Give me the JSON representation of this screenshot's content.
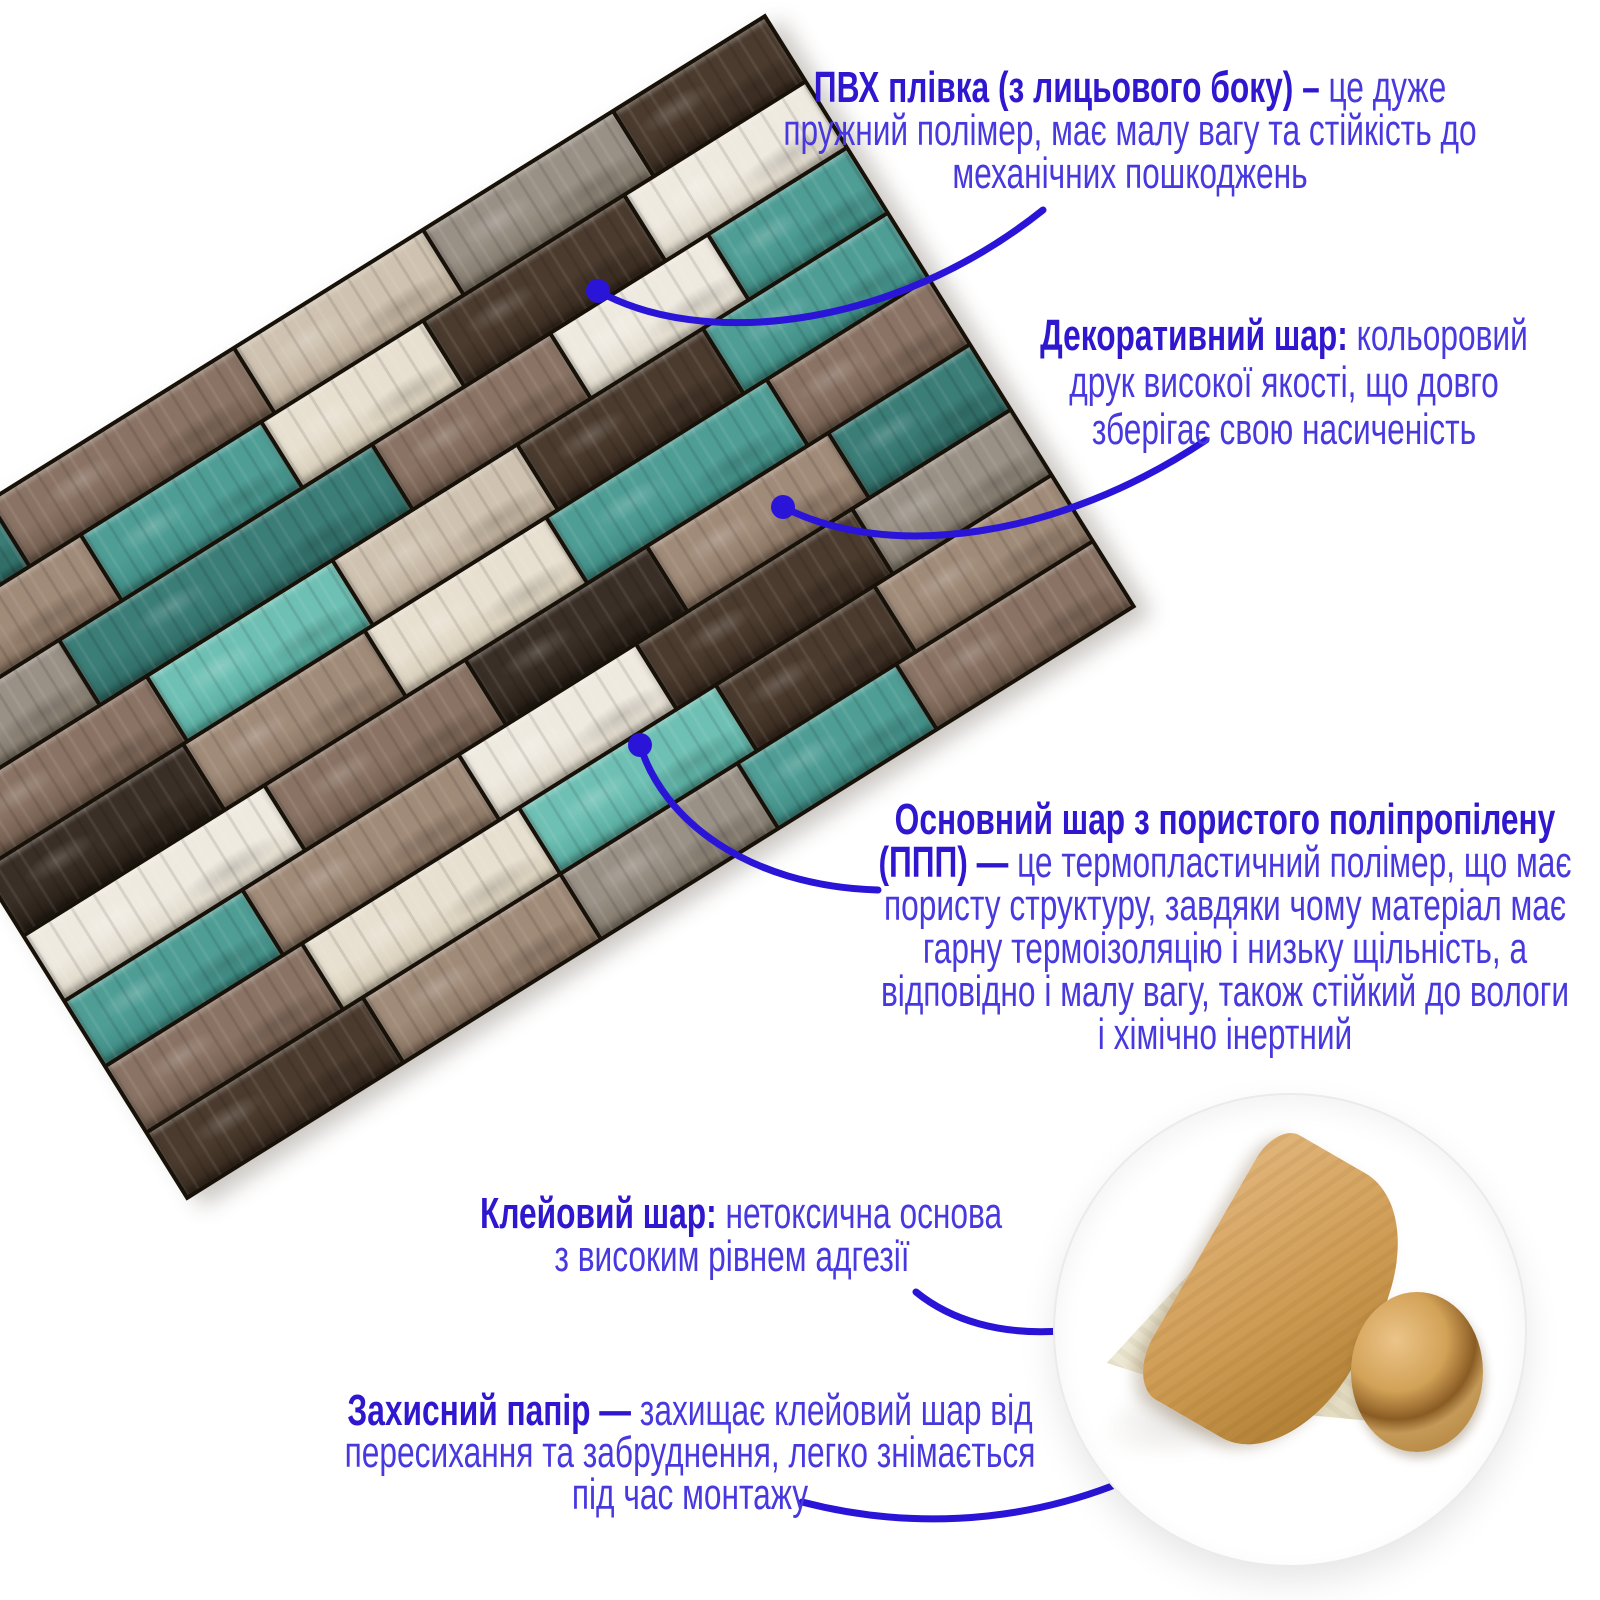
{
  "colors": {
    "accent_title": "#2e17cf",
    "accent_body": "#4738df",
    "connector": "#2a14d8",
    "background": "#ffffff",
    "kraft_paper": "#cd9a51",
    "adhesive_surface": "#e9e2c9"
  },
  "annotations": {
    "pvc": {
      "lines": [
        {
          "b": "ПВХ плівка (з лицьового боку) –",
          "r": " це дуже"
        },
        {
          "r": "пружний полімер, має малу вагу та стійкість до"
        },
        {
          "r": "механічних пошкоджень"
        }
      ]
    },
    "decor": {
      "lines": [
        {
          "b": "Декоративний шар:",
          "r": " кольоровий"
        },
        {
          "r": "друк високої якості, що довго"
        },
        {
          "r": "зберігає свою насиченість"
        }
      ]
    },
    "base": {
      "lines": [
        {
          "b": "Основний шар з пористого поліпропілену"
        },
        {
          "b": "(ППП) —",
          "r": " це термопластичний полімер, що має"
        },
        {
          "r": "пористу структуру, завдяки чому матеріал має"
        },
        {
          "r": "гарну термоізоляцію і низьку щільність, а"
        },
        {
          "r": "відповідно і малу вагу, також стійкий до вологи"
        },
        {
          "r": "і хімічно інертний"
        }
      ]
    },
    "glue": {
      "lines": [
        {
          "b": "Клейовий шар:",
          "r": " нетоксична основа"
        },
        {
          "r": "з високим рівнем адгезії"
        }
      ]
    },
    "paper": {
      "lines": [
        {
          "b": "Захисний папір —",
          "r": " захищає клейовий шар від"
        },
        {
          "r": "пересихання та забруднення, легко знімається"
        },
        {
          "r": "під час монтажу"
        }
      ]
    }
  },
  "panel": {
    "palette": {
      "teal_d": [
        "#3b7d77",
        "#2e6a64"
      ],
      "teal": [
        "#4f9e96",
        "#3d8a82"
      ],
      "teal_l": [
        "#6fc0b4",
        "#54a89c"
      ],
      "brown": [
        "#8a7364",
        "#6f5a4b"
      ],
      "brown_d": [
        "#4b3b2e",
        "#37291e"
      ],
      "taupe": [
        "#a08a78",
        "#86705e"
      ],
      "beige": [
        "#cfc2b0",
        "#b8a894"
      ],
      "cream": [
        "#e7dfcf",
        "#d4c9b4"
      ],
      "white": [
        "#efeae0",
        "#dcd5c6"
      ],
      "gray": [
        "#9a9186",
        "#7f7668"
      ],
      "black_b": [
        "#3a2f26",
        "#241c14"
      ]
    },
    "rows": [
      [
        [
          "teal_d",
          0.9
        ],
        [
          "brown",
          1.3
        ],
        [
          "beige",
          1.0
        ],
        [
          "gray",
          1.0
        ],
        [
          "brown_d",
          0.8
        ]
      ],
      [
        [
          "taupe",
          1.1
        ],
        [
          "teal",
          0.9
        ],
        [
          "cream",
          0.8
        ],
        [
          "brown_d",
          1.0
        ],
        [
          "white",
          0.9
        ]
      ],
      [
        [
          "gray",
          0.8
        ],
        [
          "teal_d",
          1.6
        ],
        [
          "brown",
          0.9
        ],
        [
          "white",
          0.8
        ],
        [
          "teal",
          0.7
        ]
      ],
      [
        [
          "brown",
          1.0
        ],
        [
          "teal_l",
          0.9
        ],
        [
          "beige",
          0.9
        ],
        [
          "brown_d",
          0.9
        ],
        [
          "teal",
          0.9
        ]
      ],
      [
        [
          "black_b",
          1.0
        ],
        [
          "taupe",
          0.9
        ],
        [
          "cream",
          0.9
        ],
        [
          "teal",
          1.1
        ],
        [
          "brown",
          0.8
        ]
      ],
      [
        [
          "white",
          1.2
        ],
        [
          "brown",
          1.0
        ],
        [
          "black_b",
          0.9
        ],
        [
          "taupe",
          0.9
        ],
        [
          "teal_d",
          0.7
        ]
      ],
      [
        [
          "teal",
          0.9
        ],
        [
          "taupe",
          1.1
        ],
        [
          "white",
          0.9
        ],
        [
          "brown_d",
          1.1
        ],
        [
          "gray",
          0.8
        ]
      ],
      [
        [
          "brown",
          1.0
        ],
        [
          "cream",
          1.1
        ],
        [
          "teal_l",
          1.0
        ],
        [
          "brown_d",
          0.8
        ],
        [
          "taupe",
          0.9
        ]
      ],
      [
        [
          "brown_d",
          1.1
        ],
        [
          "taupe",
          1.0
        ],
        [
          "gray",
          0.9
        ],
        [
          "teal",
          0.8
        ],
        [
          "brown",
          1.0
        ]
      ]
    ]
  }
}
